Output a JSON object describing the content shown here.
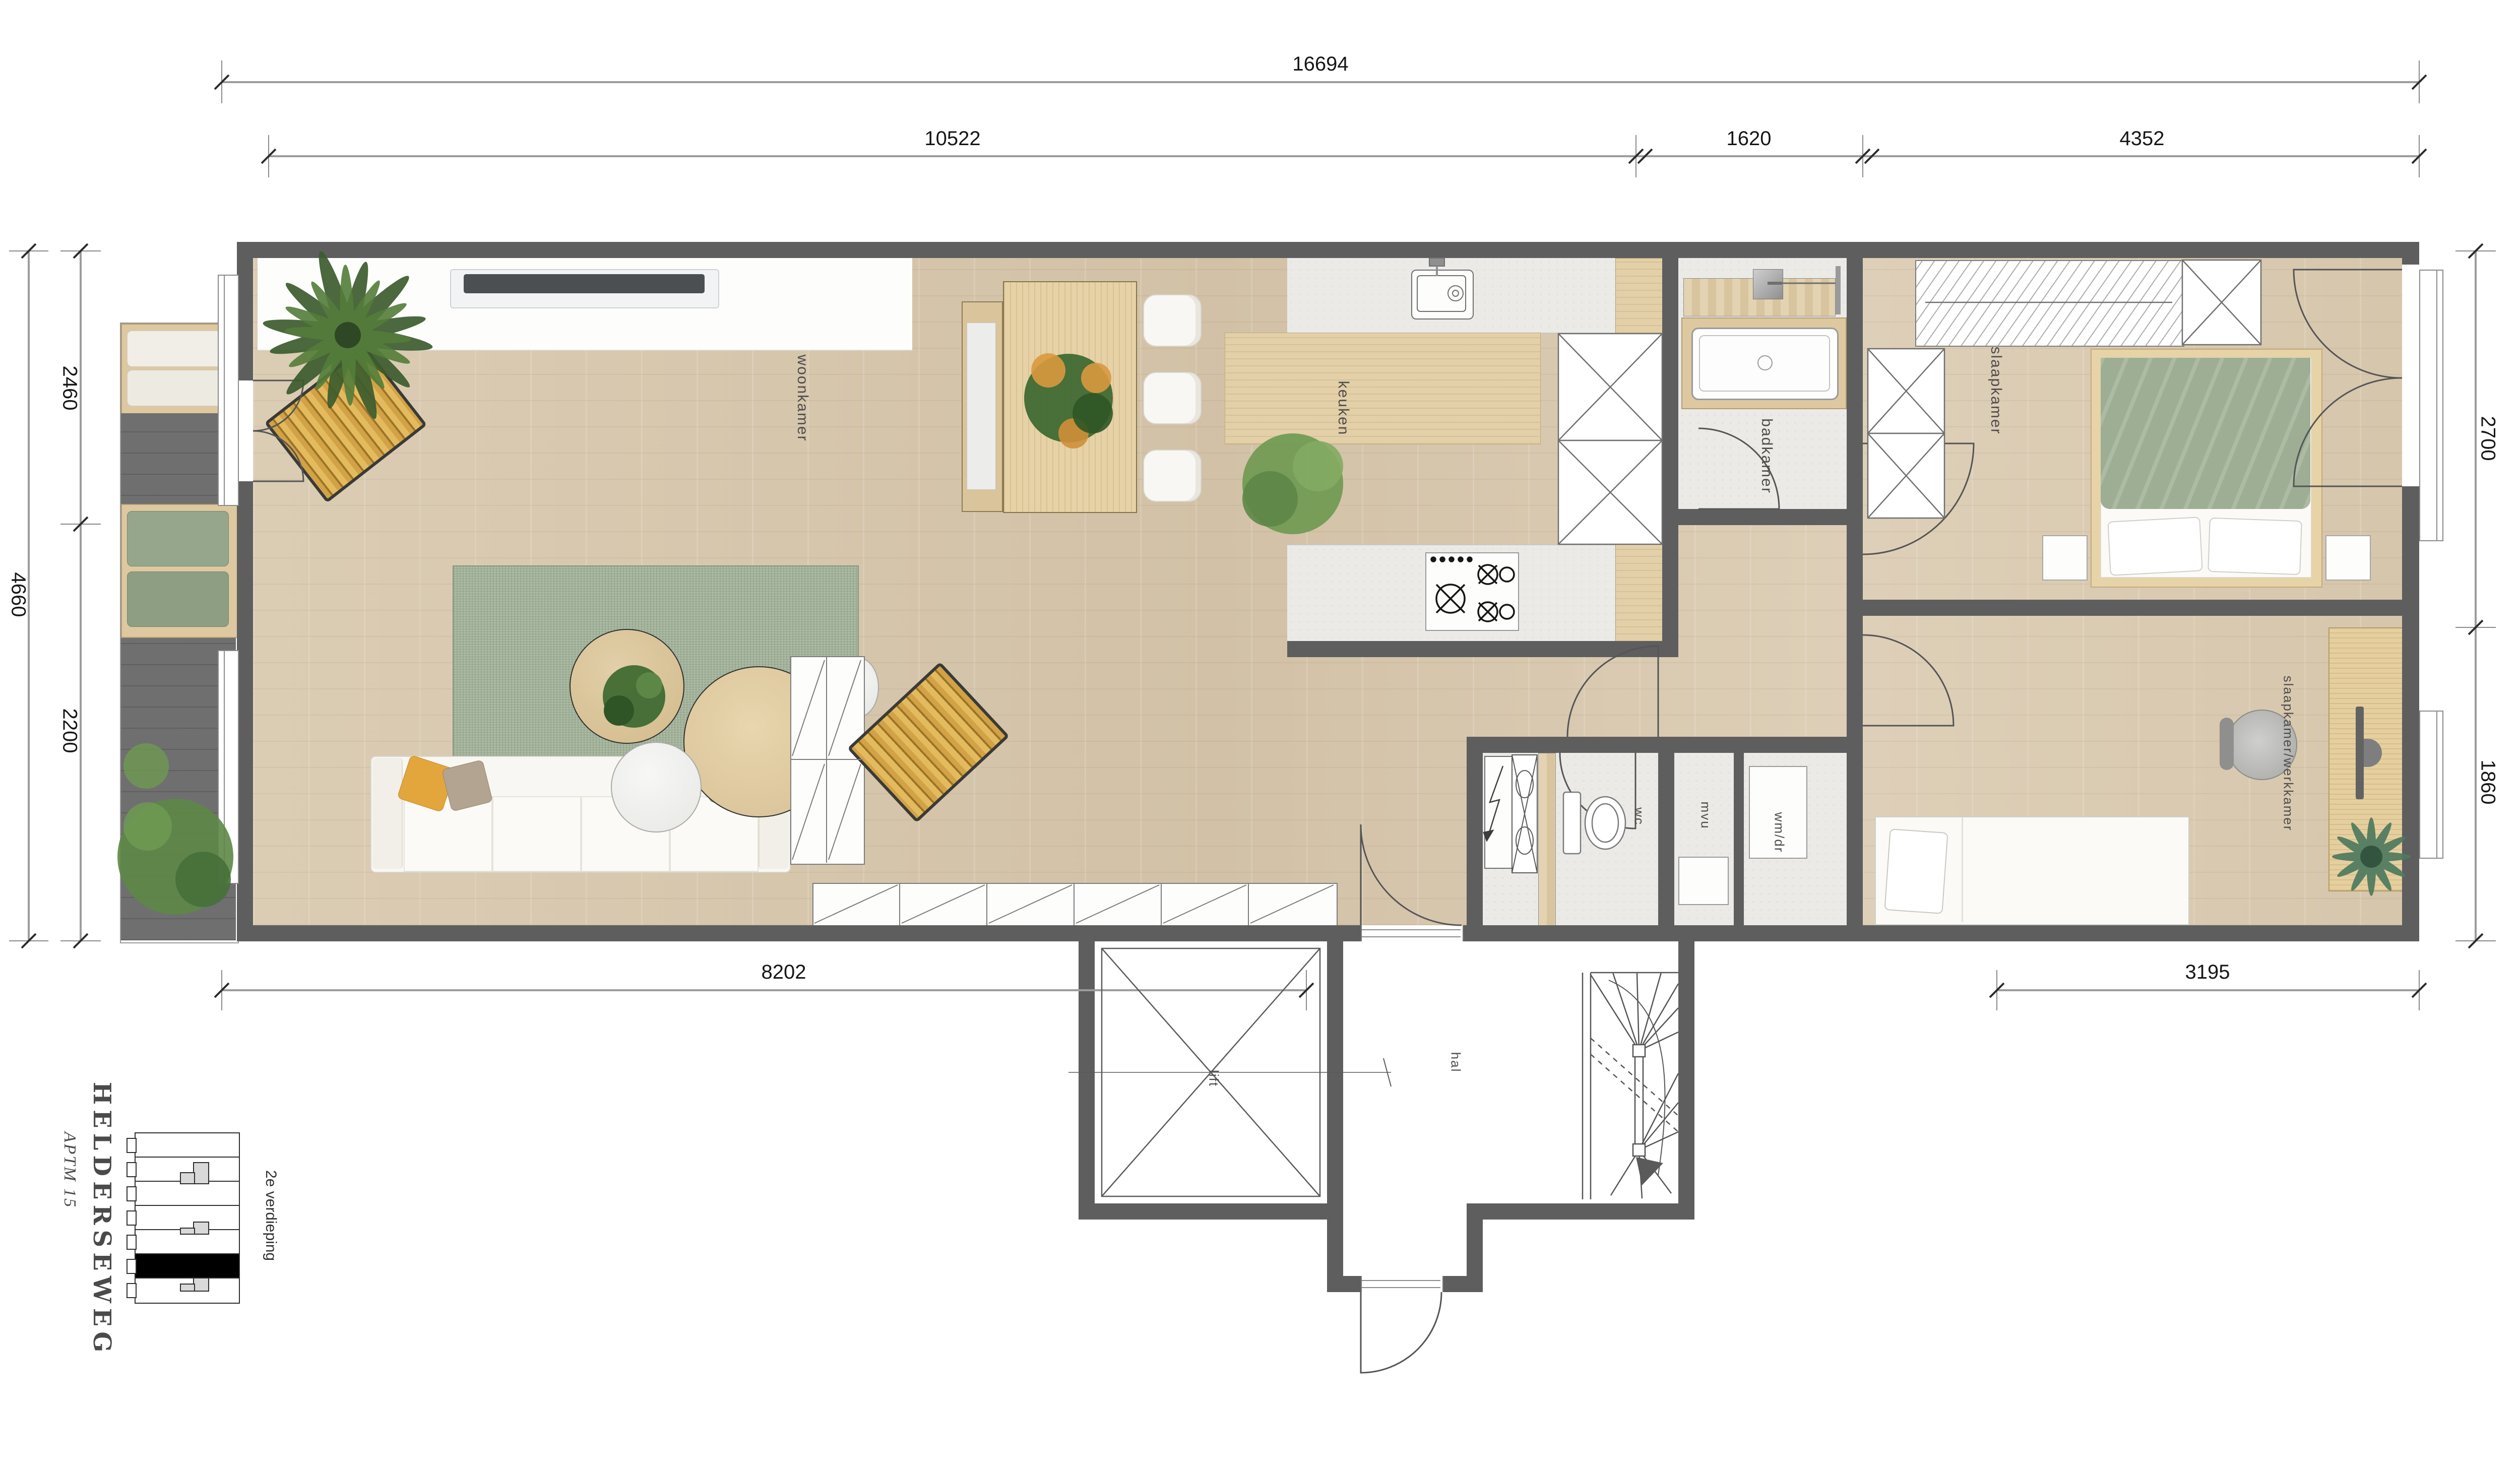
{
  "dimensions": {
    "top_total": "16694",
    "top_segments": [
      "10522",
      "1620",
      "4352"
    ],
    "left_total": "4660",
    "left_segments": [
      "2460",
      "2200"
    ],
    "right_segments": [
      "2700",
      "1860"
    ],
    "bottom_segments": [
      "8202",
      "3195"
    ]
  },
  "rooms": {
    "living": "woonkamer",
    "kitchen": "keuken",
    "bathroom": "badkamer",
    "bedroom": "slaapkamer",
    "bedroom_office": "slaapkamer/werkkamer",
    "wc": "wc",
    "storage": "mvu",
    "laundry": "wm/dr",
    "lift": "lift",
    "hall": "hal"
  },
  "title_block": {
    "street": "HELDERSEWEG",
    "apartment": "APTM 15",
    "floor_label": "2e verdieping"
  },
  "colors": {
    "wall": "#5e5e5e",
    "wood_floor": "#d9cab2",
    "tile_floor": "#ebeae7",
    "rug_green": "#a2b299",
    "cushion_green": "#96a68c",
    "cushion_yellow": "#e2a63d"
  }
}
